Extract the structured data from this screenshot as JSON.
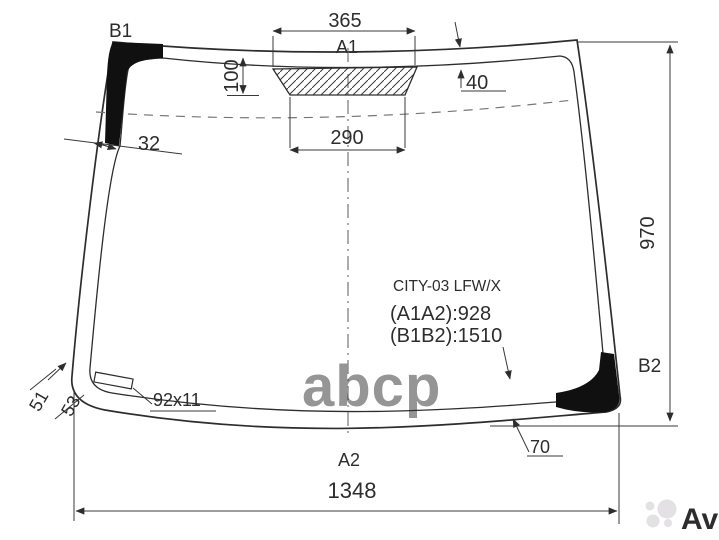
{
  "diagram": {
    "part_code": "CITY-03 LFW/X",
    "measurements": {
      "a1a2": "(A1A2):928",
      "b1b2": "(B1B2):1510"
    },
    "points": {
      "b1": "B1",
      "a1": "A1",
      "b2": "B2",
      "a2": "A2"
    },
    "dimensions": {
      "top_frit_width": "365",
      "frit_height": "100",
      "top_band_width": "40",
      "frit_bottom_width": "290",
      "side_band_width": "32",
      "glass_height": "970",
      "corner_left_outer": "51",
      "corner_left_inner": "53",
      "mirror_pad_size": "92x11",
      "bottom_corner_band": "70",
      "glass_width": "1348"
    },
    "watermarks": {
      "center": "abcp",
      "brand": "Avito"
    },
    "colors": {
      "line": "#2d2d2d",
      "band_black": "#101010",
      "watermark_center": "#a9aeb3",
      "watermark_brand": "#e3e1e3",
      "background": "#ffffff"
    }
  }
}
